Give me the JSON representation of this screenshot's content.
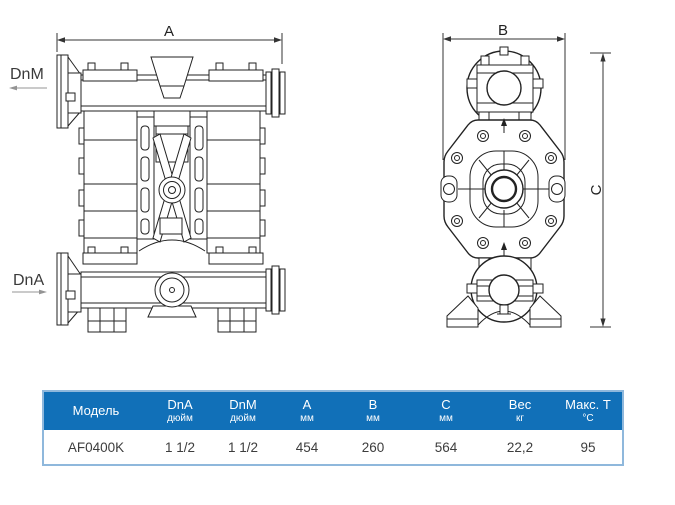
{
  "drawing": {
    "front_view": {
      "dim_width_label": "A",
      "discharge_port_label": "DnM",
      "suction_port_label": "DnA"
    },
    "side_view": {
      "dim_width_label": "B",
      "dim_height_label": "C"
    }
  },
  "table": {
    "columns": [
      {
        "label": "Модель",
        "unit": ""
      },
      {
        "label": "DnA",
        "unit": "дюйм"
      },
      {
        "label": "DnM",
        "unit": "дюйм"
      },
      {
        "label": "A",
        "unit": "мм"
      },
      {
        "label": "B",
        "unit": "мм"
      },
      {
        "label": "C",
        "unit": "мм"
      },
      {
        "label": "Вес",
        "unit": "кг"
      },
      {
        "label": "Макс. Т",
        "unit": "°C"
      }
    ],
    "rows": [
      [
        "AF0400K",
        "1 1/2",
        "1 1/2",
        "454",
        "260",
        "564",
        "22,2",
        "95"
      ]
    ]
  },
  "colors": {
    "header_bg": "#1170B8",
    "table_border": "#8FB8DC",
    "line_color": "#222222",
    "dim_arrow_gray": "#949494"
  }
}
